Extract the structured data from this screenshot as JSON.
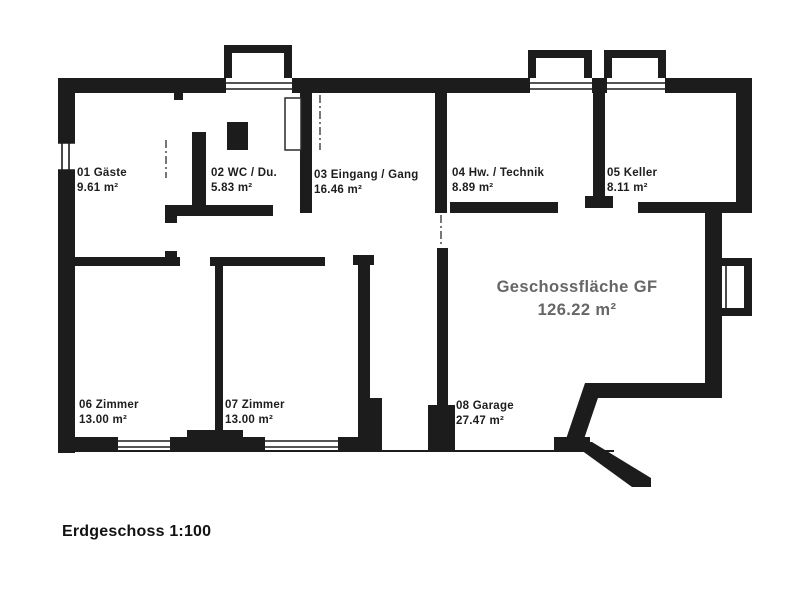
{
  "footer": {
    "title": "Erdgeschoss 1:100"
  },
  "total": {
    "label": "Geschossfläche GF",
    "area": "126.22 m²"
  },
  "rooms": [
    {
      "name": "01 Gäste",
      "area": "9.61 m²"
    },
    {
      "name": "02 WC / Du.",
      "area": "5.83 m²"
    },
    {
      "name": "03 Eingang / Gang",
      "area": "16.46 m²"
    },
    {
      "name": "04 Hw. / Technik",
      "area": "8.89 m²"
    },
    {
      "name": "05 Keller",
      "area": "8.11 m²"
    },
    {
      "name": "06 Zimmer",
      "area": "13.00 m²"
    },
    {
      "name": "07 Zimmer",
      "area": "13.00 m²"
    },
    {
      "name": "08 Garage",
      "area": "27.47 m²"
    }
  ],
  "colors": {
    "wall": "#1c1c1c",
    "room_text": "#1d1d1d",
    "total_text": "#666666",
    "background": "#ffffff"
  }
}
